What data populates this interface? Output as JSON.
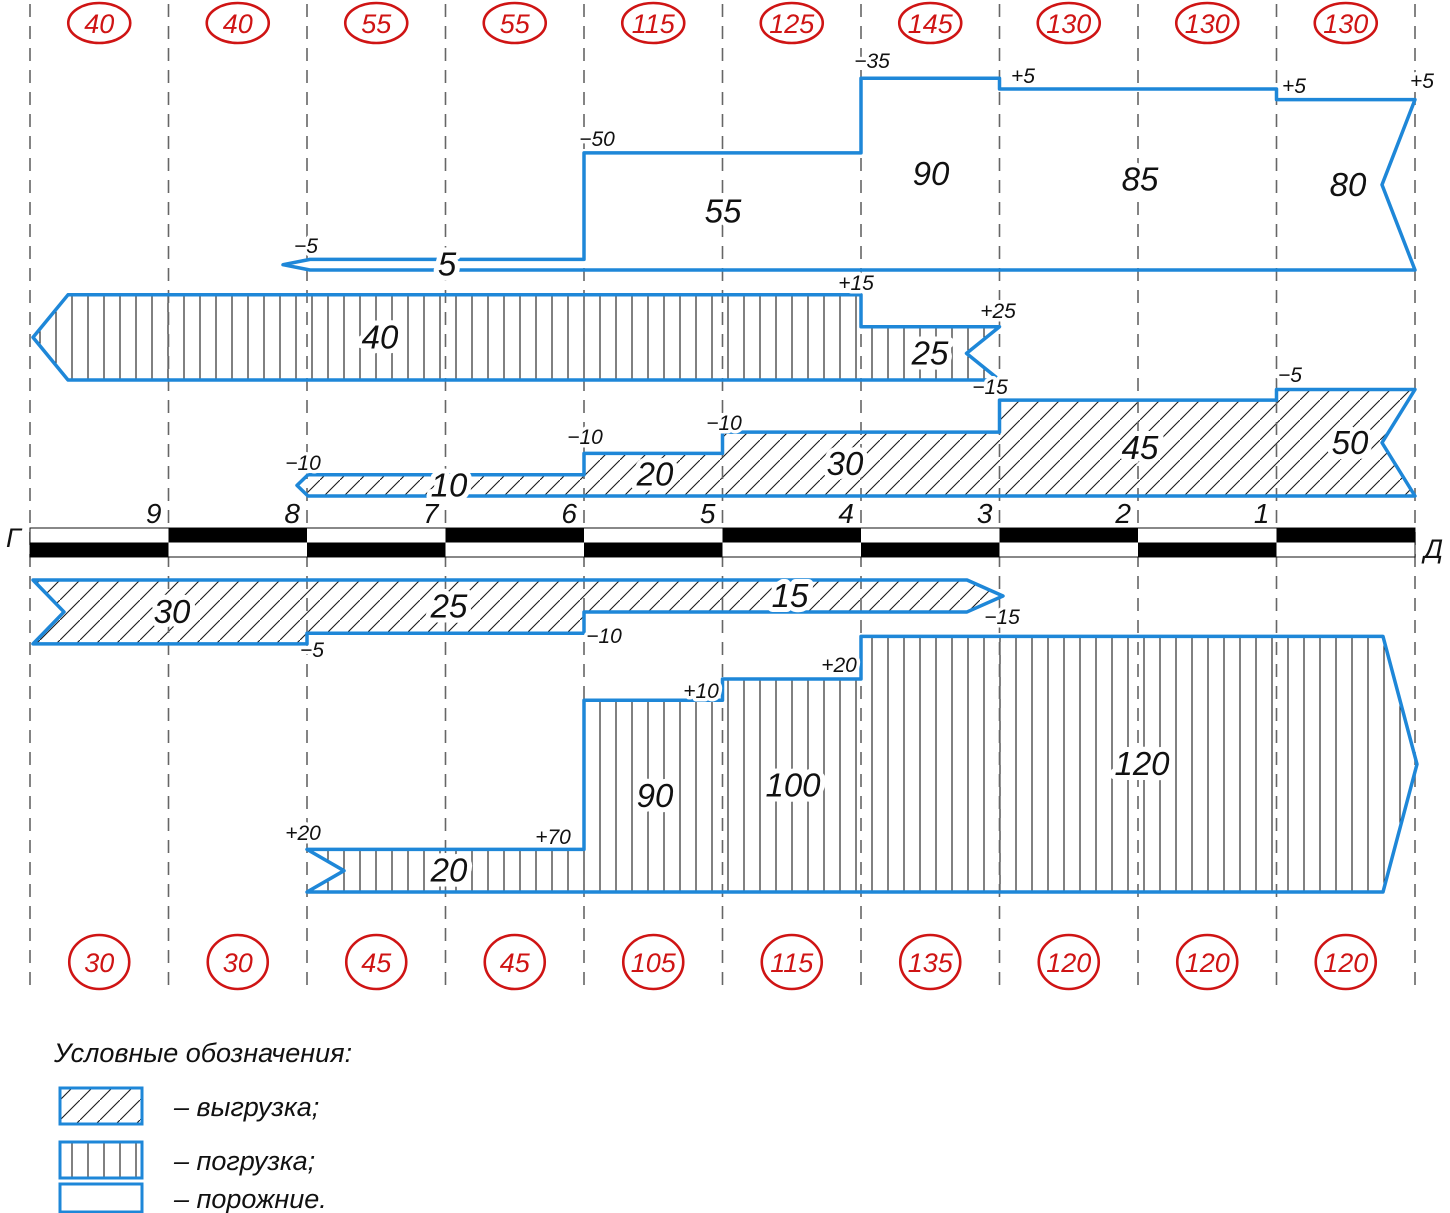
{
  "page": {
    "background": "#ffffff"
  },
  "colors": {
    "blue": "#1e87d8",
    "red": "#cf1414",
    "ink": "#111111",
    "dash": "#666666",
    "hatch": "#1a1a1a"
  },
  "axis": {
    "left_terminal": "Г",
    "right_terminal": "Д",
    "station_labels": [
      "9",
      "8",
      "7",
      "6",
      "5",
      "4",
      "3",
      "2",
      "1"
    ]
  },
  "legend": {
    "title": "Условные обозначения:",
    "items": [
      {
        "swatch": "diag",
        "label": "– выгрузка;"
      },
      {
        "swatch": "vert",
        "label": "– погрузка;"
      },
      {
        "swatch": "none",
        "label": "– порожние."
      }
    ]
  },
  "chart_data": {
    "type": "cargo-flow-band-diagram",
    "px_per_car": 2.13,
    "station_x": [
      30,
      168.5,
      307,
      445.5,
      584,
      722.5,
      861,
      999.5,
      1138,
      1276.5,
      1415
    ],
    "dash_y": [
      4,
      992
    ],
    "axis_bar": {
      "y_top": 528,
      "row_h": 14.5,
      "top_black_intervals": [
        1,
        3,
        5,
        7,
        9
      ],
      "bottom_black_intervals": [
        0,
        2,
        4,
        6,
        8
      ]
    },
    "interval_totals_top": [
      40,
      40,
      55,
      55,
      115,
      125,
      145,
      130,
      130,
      130
    ],
    "interval_totals_bottom": [
      30,
      30,
      45,
      45,
      105,
      115,
      135,
      120,
      120,
      120
    ],
    "circles": {
      "top_cy": 23,
      "top_rx": 31,
      "top_ry": 20,
      "bottom_cy": 962,
      "bottom_rx": 30,
      "bottom_ry": 27
    },
    "bands": [
      {
        "id": "empty-top",
        "meaning": "порожние",
        "hatch": "none",
        "flat": "bottom",
        "baseline": 270,
        "start": {
          "type": "point",
          "x": 283,
          "base": 310
        },
        "end": {
          "type": "notch",
          "x": 1415,
          "depth": 33
        },
        "sections": [
          {
            "to": 584,
            "v": 5,
            "label": "5",
            "lx": 447
          },
          {
            "to": 861,
            "v": 55,
            "label": "55",
            "lx": 723
          },
          {
            "to": 999.5,
            "v": 90,
            "label": "90",
            "lx": 931
          },
          {
            "to": 1276.5,
            "v": 85,
            "label": "85",
            "lx": 1140
          },
          {
            "to": 1415,
            "v": 80,
            "label": "80",
            "lx": 1348
          }
        ],
        "ann": [
          {
            "t": "−5",
            "x": 306,
            "y": 253
          },
          {
            "t": "−50",
            "x": 597,
            "y": 146
          },
          {
            "t": "−35",
            "x": 872,
            "y": 68
          },
          {
            "t": "+5",
            "x": 1023,
            "y": 83
          },
          {
            "t": "+5",
            "x": 1294,
            "y": 93
          },
          {
            "t": "+5",
            "x": 1422,
            "y": 88
          }
        ]
      },
      {
        "id": "load-top",
        "meaning": "погрузка",
        "hatch": "vert",
        "flat": "bottom",
        "baseline": 380,
        "start": {
          "type": "point",
          "x": 33,
          "base": 68
        },
        "end": {
          "type": "notch",
          "x": 999.5,
          "depth": 33
        },
        "sections": [
          {
            "to": 861,
            "v": 40,
            "label": "40",
            "lx": 380
          },
          {
            "to": 999.5,
            "v": 25,
            "label": "25",
            "lx": 930
          }
        ],
        "ann": [
          {
            "t": "+15",
            "x": 856,
            "y": 290
          },
          {
            "t": "+25",
            "x": 998,
            "y": 318
          }
        ]
      },
      {
        "id": "unload-top",
        "meaning": "выгрузка",
        "hatch": "diag",
        "flat": "bottom",
        "baseline": 496,
        "start": {
          "type": "point",
          "x": 297,
          "base": 308
        },
        "end": {
          "type": "notch",
          "x": 1415,
          "depth": 33
        },
        "sections": [
          {
            "to": 584,
            "v": 10,
            "label": "10",
            "lx": 449
          },
          {
            "to": 722.5,
            "v": 20,
            "label": "20",
            "lx": 655
          },
          {
            "to": 999.5,
            "v": 30,
            "label": "30",
            "lx": 845
          },
          {
            "to": 1276.5,
            "v": 45,
            "label": "45",
            "lx": 1140
          },
          {
            "to": 1415,
            "v": 50,
            "label": "50",
            "lx": 1350
          }
        ],
        "ann": [
          {
            "t": "−10",
            "x": 303,
            "y": 470
          },
          {
            "t": "−10",
            "x": 585,
            "y": 444
          },
          {
            "t": "−10",
            "x": 724,
            "y": 430
          },
          {
            "t": "−15",
            "x": 990,
            "y": 394
          },
          {
            "t": "−5",
            "x": 1290,
            "y": 382
          }
        ]
      },
      {
        "id": "unload-bottom",
        "meaning": "выгрузка",
        "hatch": "diag",
        "flat": "top",
        "baseline": 580,
        "start": {
          "type": "notch",
          "x": 33,
          "depth": 31
        },
        "end": {
          "type": "point",
          "x": 1003,
          "base": 967
        },
        "sections": [
          {
            "to": 307,
            "v": 30,
            "label": "30",
            "lx": 172
          },
          {
            "to": 584,
            "v": 25,
            "label": "25",
            "lx": 449
          },
          {
            "to": 967,
            "v": 15,
            "label": "15",
            "lx": 790
          }
        ],
        "ann": [
          {
            "t": "−5",
            "x": 312,
            "y": 657
          },
          {
            "t": "−10",
            "x": 604,
            "y": 643
          },
          {
            "t": "−15",
            "x": 1002,
            "y": 624
          }
        ]
      },
      {
        "id": "load-bottom",
        "meaning": "погрузка",
        "hatch": "vert",
        "flat": "bottom",
        "baseline": 892,
        "start": {
          "type": "notch",
          "x": 307,
          "depth": 37
        },
        "end": {
          "type": "point",
          "x": 1417,
          "base": 1383
        },
        "sections": [
          {
            "to": 584,
            "v": 20,
            "label": "20",
            "lx": 449
          },
          {
            "to": 722.5,
            "v": 90,
            "label": "90",
            "lx": 655
          },
          {
            "to": 861,
            "v": 100,
            "label": "100",
            "lx": 793
          },
          {
            "to": 1383,
            "v": 120,
            "label": "120",
            "lx": 1142
          }
        ],
        "ann": [
          {
            "t": "+20",
            "x": 303,
            "y": 840
          },
          {
            "t": "+70",
            "x": 553,
            "y": 844
          },
          {
            "t": "+10",
            "x": 701,
            "y": 698
          },
          {
            "t": "+20",
            "x": 839,
            "y": 672
          }
        ]
      }
    ]
  }
}
